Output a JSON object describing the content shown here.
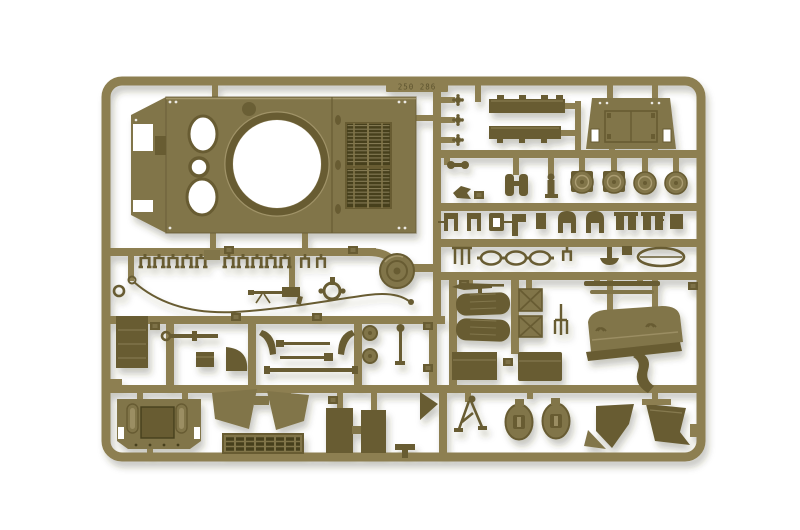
{
  "photo": {
    "subject": "injection-molded-model-kit-sprue",
    "background": "plain-white"
  },
  "markings": {
    "mold_stamp": "250 286"
  },
  "colors": {
    "bg": "#ffffff",
    "sprue": "#8d7f51",
    "sprue_light": "#a89a6c",
    "part": "#81744a",
    "part_dark": "#675c33",
    "slot": "#46401f",
    "light": "#b5a87c",
    "stamp": "#554c28",
    "shadow": "#3c3522"
  },
  "parts": [
    "sprue-frame",
    "mold-stamp-tab",
    "upper-hull-panel",
    "turret-ring-opening",
    "crew-hatch-opening",
    "engine-deck-grille",
    "fender-strip",
    "rear-door-panel",
    "round-cap",
    "binoculars",
    "knob-clip",
    "grab-handle",
    "tow-cable",
    "machine-gun",
    "idler-wheel",
    "ring-sight",
    "stowage-box",
    "ring-pin-rod",
    "quarter-fan",
    "axe-blade",
    "tool-rod",
    "pulley-disc",
    "rifle",
    "bedroll",
    "strapped-crate",
    "pitchfork",
    "flat-strip",
    "exhaust-deflector",
    "stowage-bin",
    "strap-hook",
    "rear-hull-plate",
    "mudguard",
    "intake-grille",
    "side-panel",
    "t-bracket",
    "wedge",
    "tripod",
    "oval-hatch-cover",
    "mud-flap",
    "u-bracket",
    "dome-bracket",
    "block-pair",
    "chain-link",
    "oval-grab-rail",
    "mushroom-pin",
    "part-number-tag"
  ]
}
